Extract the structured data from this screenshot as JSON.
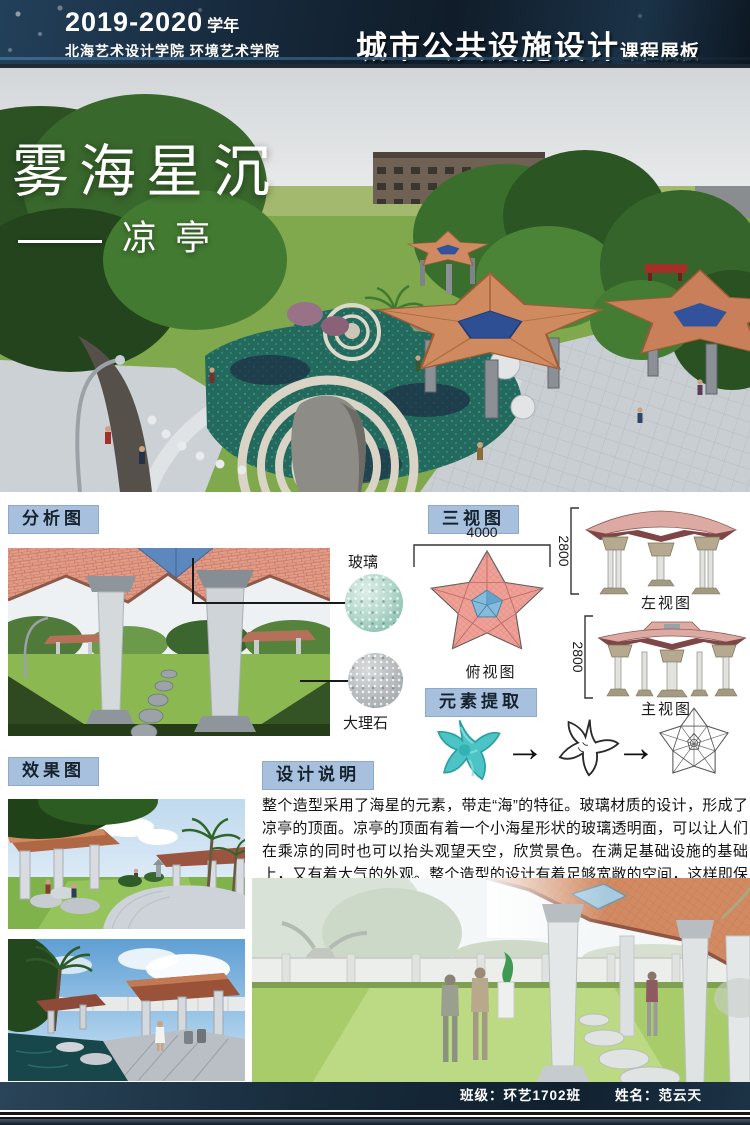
{
  "header": {
    "year_number": "2019-2020",
    "year_suffix": "学年",
    "school": "北海艺术设计学院 环境艺术学院",
    "course_title": "城市公共设施设计",
    "course_suffix": "课程展板"
  },
  "hero": {
    "title": "雾海星沉",
    "subtitle": "凉亭"
  },
  "sections": {
    "analysis": {
      "label": "分析图",
      "materials": [
        {
          "name": "玻璃"
        },
        {
          "name": "大理石"
        }
      ]
    },
    "three_views": {
      "label": "三视图",
      "top_width_dim": "4000",
      "left_height_dim": "2800",
      "front_height_dim": "2800",
      "top_view_label": "俯视图",
      "left_view_label": "左视图",
      "front_view_label": "主视图"
    },
    "element_extraction": {
      "label": "元素提取",
      "arrow": "→"
    },
    "renderings": {
      "label": "效果图"
    },
    "description": {
      "label": "设计说明",
      "text": "整个造型采用了海星的元素，带走“海”的特征。玻璃材质的设计，形成了凉亭的顶面。凉亭的顶面有着一个小海星形状的玻璃透明面，可以让人们在乘凉的同时也可以抬头观望天空，欣赏景色。在满足基础设施的基础上，又有着大气的外观。整个造型的设计有着足够宽敞的空间，这样即保证了良好的流动性，又保证了良好功能性。可以广泛运用于公园等公共场所。"
    }
  },
  "footer": {
    "class_label": "班级：环艺1702班",
    "name_label": "姓名：范云天"
  },
  "colors": {
    "badge_blue": "#a6c0dd",
    "header_navy": "#16283a",
    "roof_terracotta": "#d08a5f",
    "glass_blue": "#5c88bd",
    "water_teal": "#24695d",
    "starfish_teal": "#4cc4c6",
    "topview_pink": "#efa097"
  }
}
